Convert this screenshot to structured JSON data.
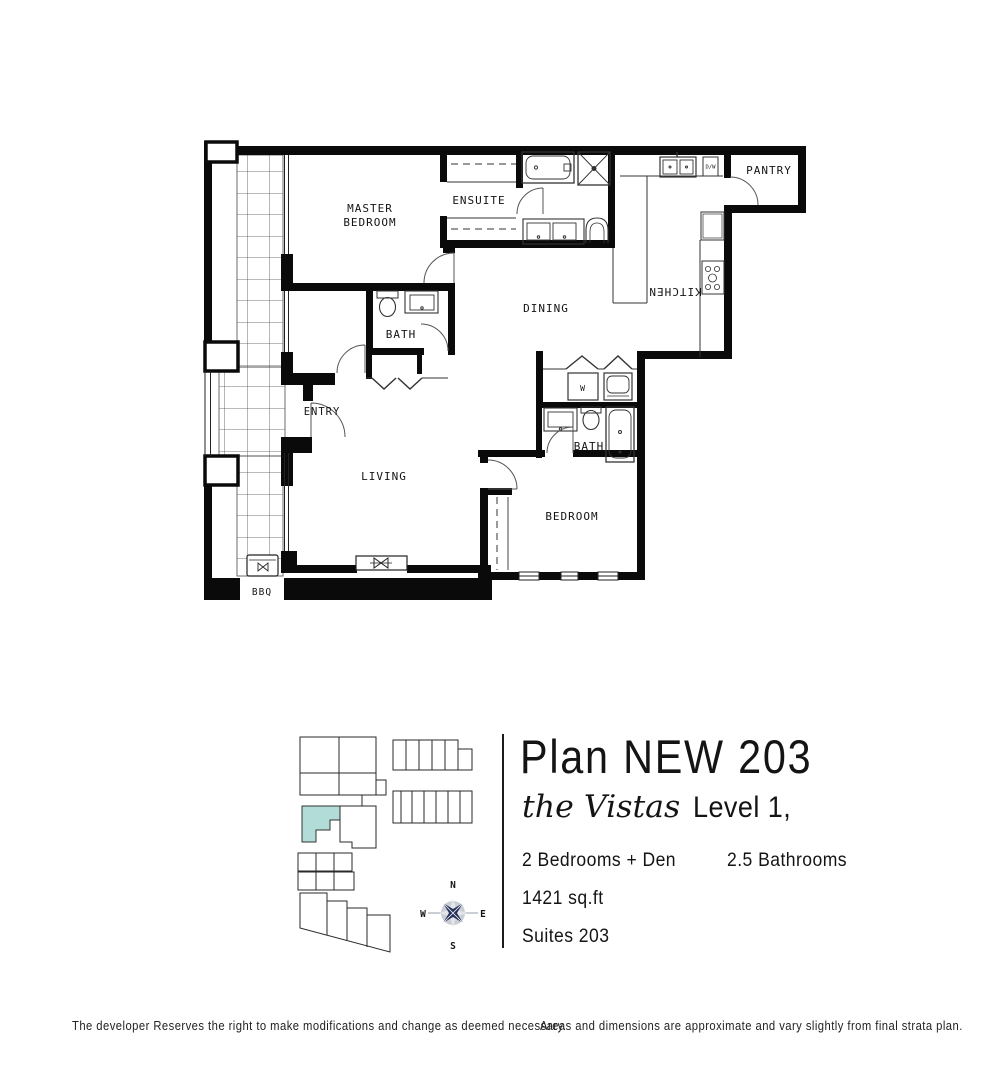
{
  "info": {
    "plan_title": "Plan NEW 203",
    "brand_script": "the Vistas",
    "level": "Level 1,",
    "bedrooms": "2 Bedrooms + Den",
    "bathrooms": "2.5 Bathrooms",
    "area": "1421 sq.ft",
    "suites": "Suites 203"
  },
  "floor_plan": {
    "rooms": {
      "master_line1": "MASTER",
      "master_line2": "BEDROOM",
      "ensuite": "ENSUITE",
      "pantry": "PANTRY",
      "kitchen": "KITCHEN",
      "dining": "DINING",
      "bath_upper": "BATH",
      "entry": "ENTRY",
      "living": "LIVING",
      "bath_lower": "BATH",
      "bedroom": "BEDROOM",
      "bbq": "BBQ"
    },
    "appliances": {
      "washer": "W",
      "dishwasher": "D/W"
    }
  },
  "key_plan": {
    "highlight_color": "#b2dcd8",
    "compass": {
      "n": "N",
      "e": "E",
      "s": "S",
      "w": "W"
    }
  },
  "footer": {
    "left": "The developer Reserves the right to make modifications and change as deemed necessary.",
    "right": "Areas and dimensions are approximate and vary slightly from final strata plan."
  }
}
